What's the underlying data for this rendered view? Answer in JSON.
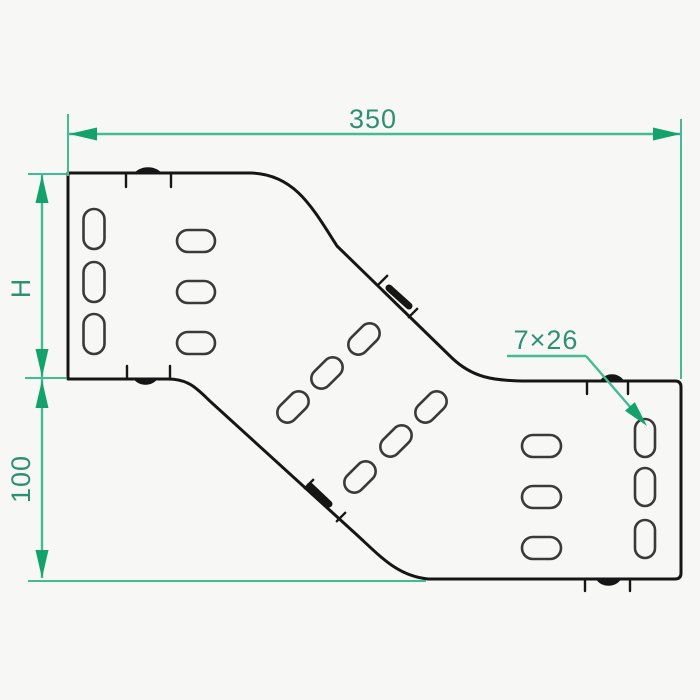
{
  "drawing": {
    "type": "technical-drawing-side-profile-reducer",
    "labels": {
      "width_dim": "350",
      "left_height_dim": "H",
      "lower_height_dim": "100",
      "slot_callout": "7×26"
    },
    "slot_groups": [
      {
        "name": "left-outer-column",
        "orientation": "vertical",
        "count": 3
      },
      {
        "name": "left-inner-column",
        "orientation": "horizontal",
        "count": 3
      },
      {
        "name": "upper-diagonal-row",
        "orientation": "diagonal",
        "count": 3
      },
      {
        "name": "lower-diagonal-row",
        "orientation": "diagonal",
        "count": 3
      },
      {
        "name": "right-inner-column",
        "orientation": "horizontal",
        "count": 3
      },
      {
        "name": "right-outer-column",
        "orientation": "vertical",
        "count": 3
      }
    ]
  },
  "colors": {
    "background": "#f7f7f6",
    "outline": "#161616",
    "slot": "#3a3a3a",
    "dim_line": "#43bc95",
    "dim_arrow": "#13a26c",
    "dim_text": "#2f8f74"
  }
}
